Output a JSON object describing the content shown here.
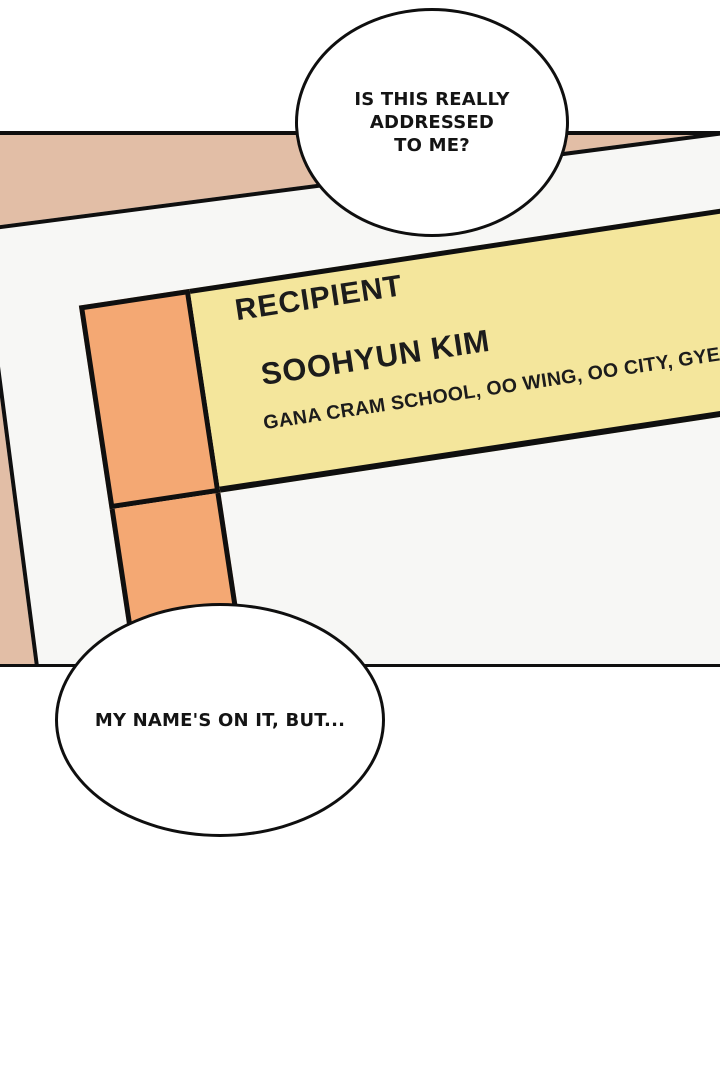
{
  "scene": {
    "type": "webtoon-comic-panel"
  },
  "speech_bubbles": {
    "top": {
      "lines": [
        "IS THIS REALLY",
        "ADDRESSED",
        "TO ME?"
      ]
    },
    "bottom": {
      "text": "MY NAME'S ON IT, BUT..."
    }
  },
  "shipping_label": {
    "recipient_heading": "RECIPIENT",
    "recipient_name": "SOOHYUN KIM",
    "address_line": "GANA CRAM SCHOOL, OO WING, OO CITY, GYEO"
  },
  "colors": {
    "panel_background": "#e2bea6",
    "envelope": "#f7f7f5",
    "label_yellow": "#f4e69c",
    "label_orange": "#f4a873",
    "ink": "#0f0f0f"
  }
}
